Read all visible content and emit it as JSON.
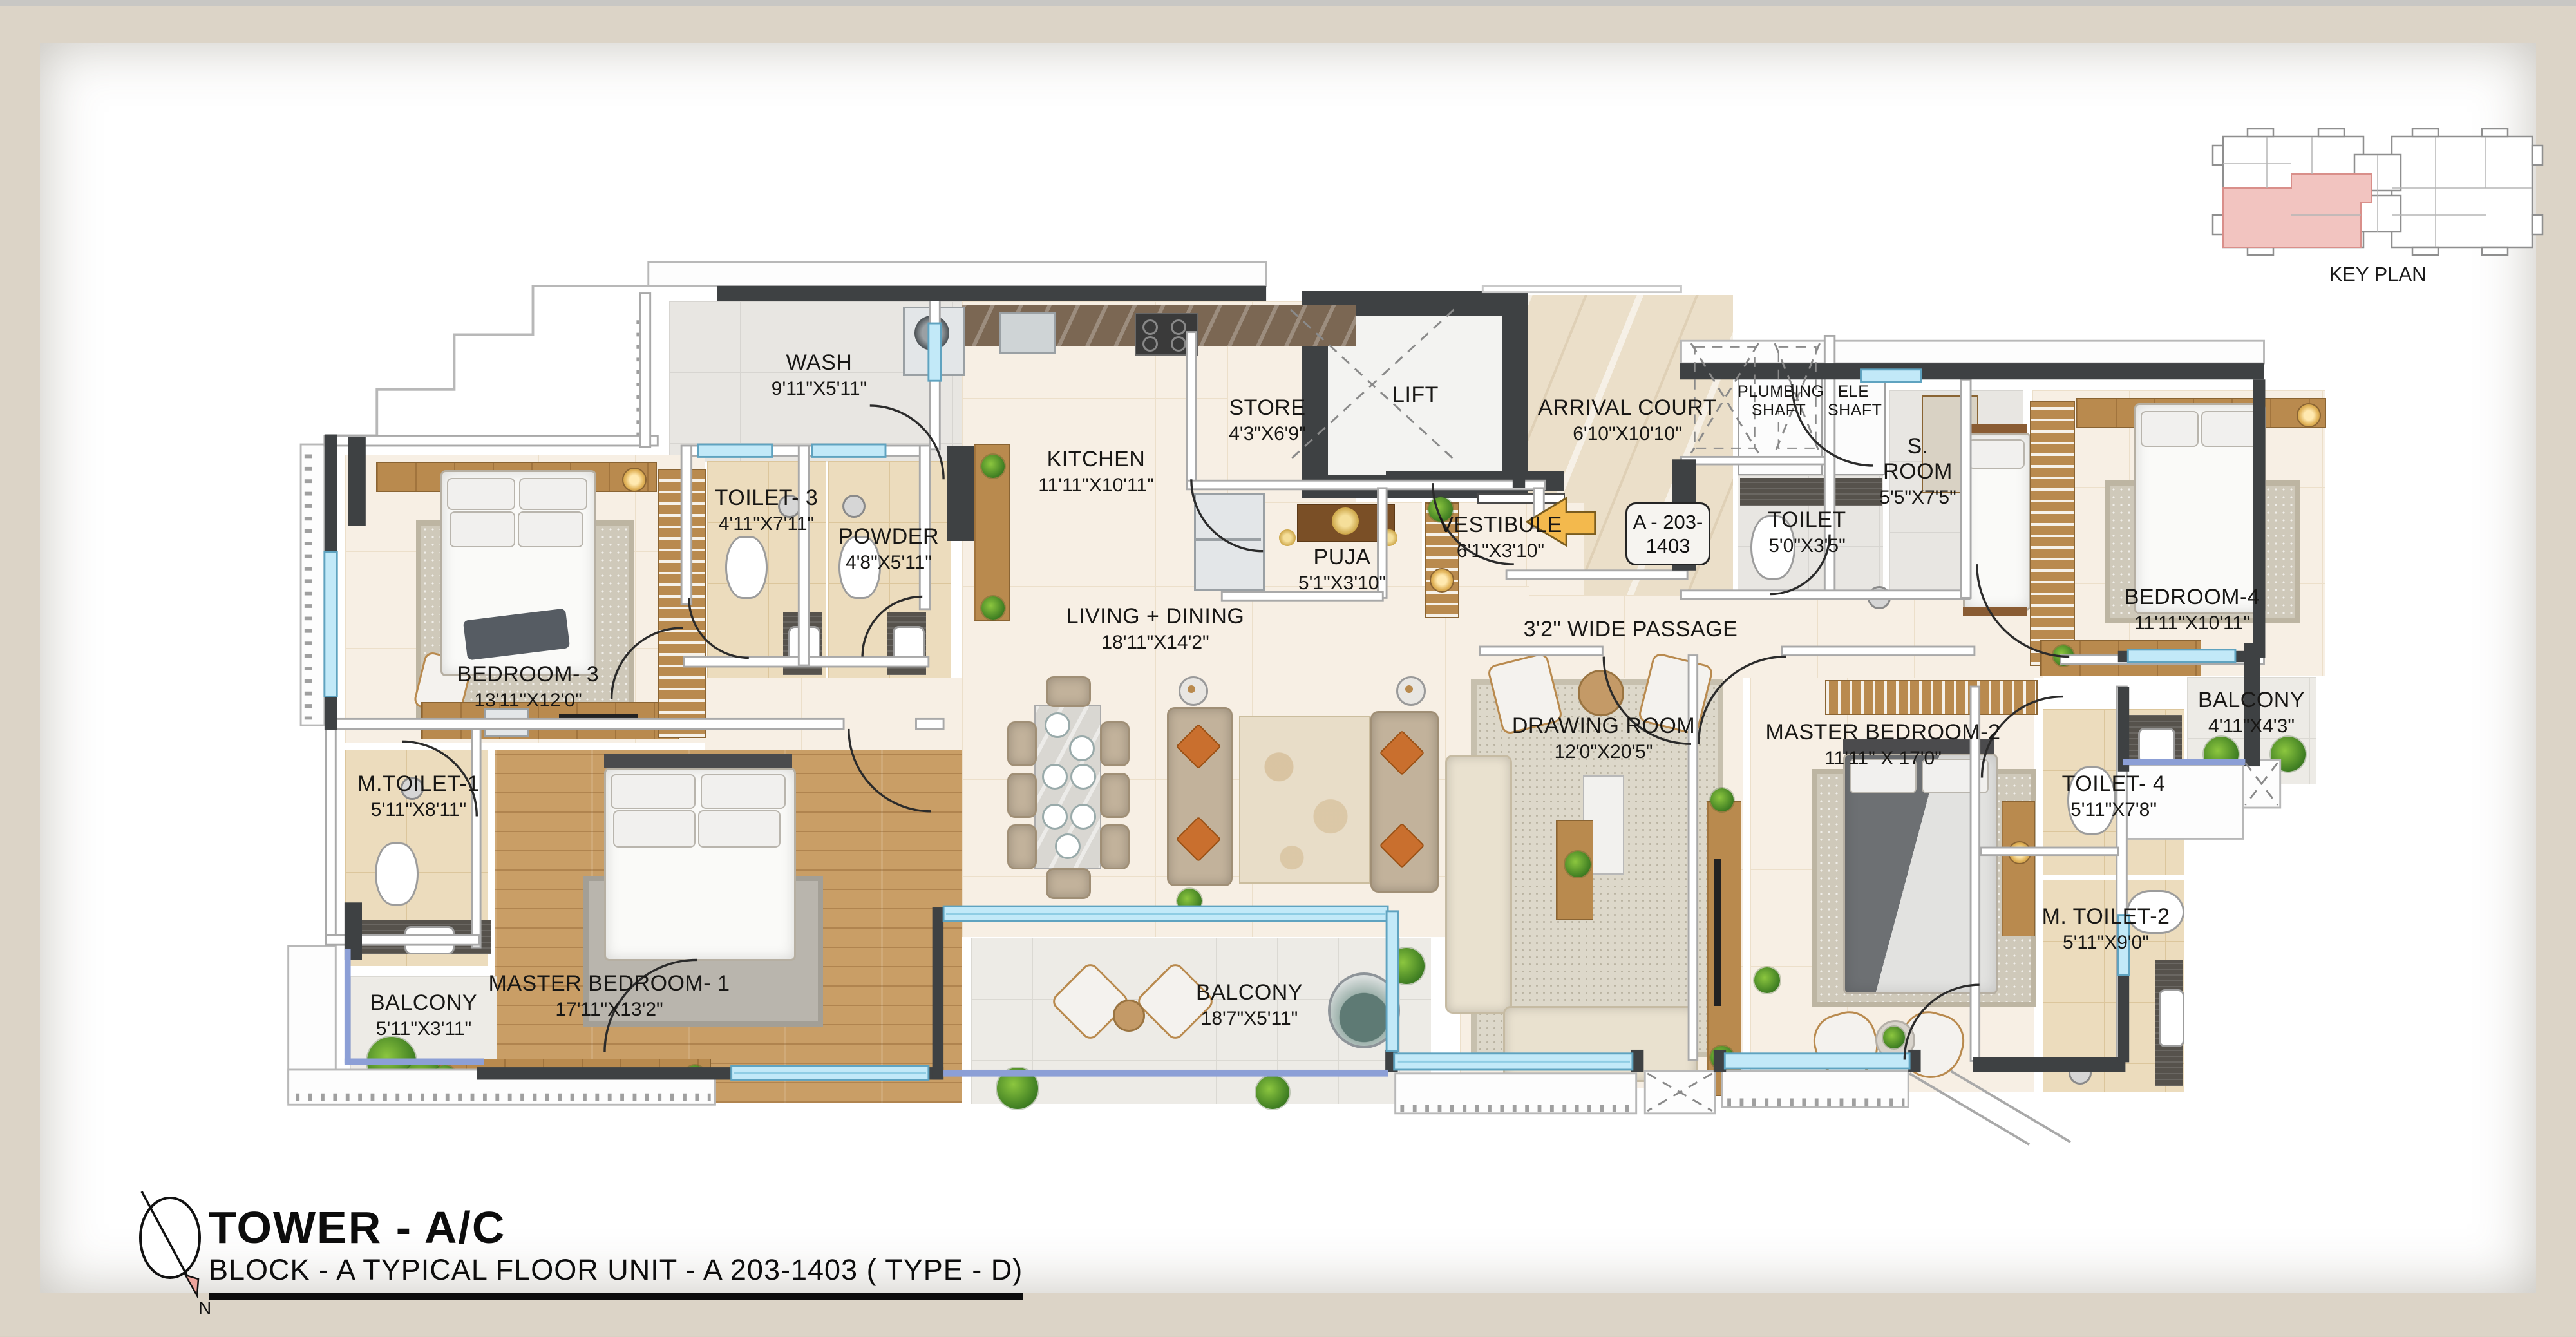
{
  "title": {
    "tower": "TOWER - A/C",
    "block": "BLOCK - A TYPICAL FLOOR UNIT - A 203-1403 ( TYPE - D)"
  },
  "key_plan": {
    "label": "KEY PLAN"
  },
  "compass": {
    "north_label": "N"
  },
  "unit_tag": {
    "line1": "A - 203-",
    "line2": "1403"
  },
  "rooms": {
    "wash": {
      "name": "WASH",
      "dims": "9'11\"X5'11\""
    },
    "toilet3": {
      "name": "TOILET- 3",
      "dims": "4'11\"X7'11\""
    },
    "powder": {
      "name": "POWDER",
      "dims": "4'8\"X5'11\""
    },
    "kitchen": {
      "name": "KITCHEN",
      "dims": "11'11\"X10'11\""
    },
    "store": {
      "name": "STORE",
      "dims": "4'3\"X6'9\""
    },
    "lift": {
      "name": "LIFT",
      "dims": ""
    },
    "arrival": {
      "name": "ARRIVAL COURT",
      "dims": "6'10\"X10'10\""
    },
    "plumbing": {
      "name": "PLUMBING SHAFT",
      "dims": ""
    },
    "ele": {
      "name": "ELE SHAFT",
      "dims": ""
    },
    "toilet": {
      "name": "TOILET",
      "dims": "5'0\"X3'5\""
    },
    "sroom": {
      "name": "S. ROOM",
      "dims": "5'5\"X7'5\""
    },
    "bedroom4": {
      "name": "BEDROOM-4",
      "dims": "11'11\"X10'11\""
    },
    "balcony_r": {
      "name": "BALCONY",
      "dims": "4'11\"X4'3\""
    },
    "toilet4": {
      "name": "TOILET- 4",
      "dims": "5'11\"X7'8\""
    },
    "mtoilet2": {
      "name": "M. TOILET-2",
      "dims": "5'11\"X9'0\""
    },
    "mbr2": {
      "name": "MASTER BEDROOM-2",
      "dims": "11'11\" X 17'0\""
    },
    "drawing": {
      "name": "DRAWING ROOM",
      "dims": "12'0\"X20'5\""
    },
    "passage": {
      "name": "3'2\" WIDE PASSAGE",
      "dims": ""
    },
    "living": {
      "name": "LIVING + DINING",
      "dims": "18'11\"X14'2\""
    },
    "puja": {
      "name": "PUJA",
      "dims": "5'1\"X3'10\""
    },
    "vestibule": {
      "name": "VESTIBULE",
      "dims": "6'1\"X3'10\""
    },
    "bedroom3": {
      "name": "BEDROOM- 3",
      "dims": "13'11\"X12'0\""
    },
    "mtoilet1": {
      "name": "M.TOILET-1",
      "dims": "5'11\"X8'11\""
    },
    "mbr1": {
      "name": "MASTER BEDROOM- 1",
      "dims": "17'11\"X13'2\""
    },
    "balcony_c": {
      "name": "BALCONY",
      "dims": "18'7\"X5'11\""
    },
    "balcony_bl": {
      "name": "BALCONY",
      "dims": "5'11\"X3'11\""
    }
  },
  "colors": {
    "wall_dark": "#3e4143",
    "window_blue": "#c2e9f8",
    "rail_blue": "#8c9fd6",
    "keyplan_highlight": "#f2c4c0",
    "entry_arrow": "#f3b94d",
    "frame_beige": "#dcd4c7"
  }
}
